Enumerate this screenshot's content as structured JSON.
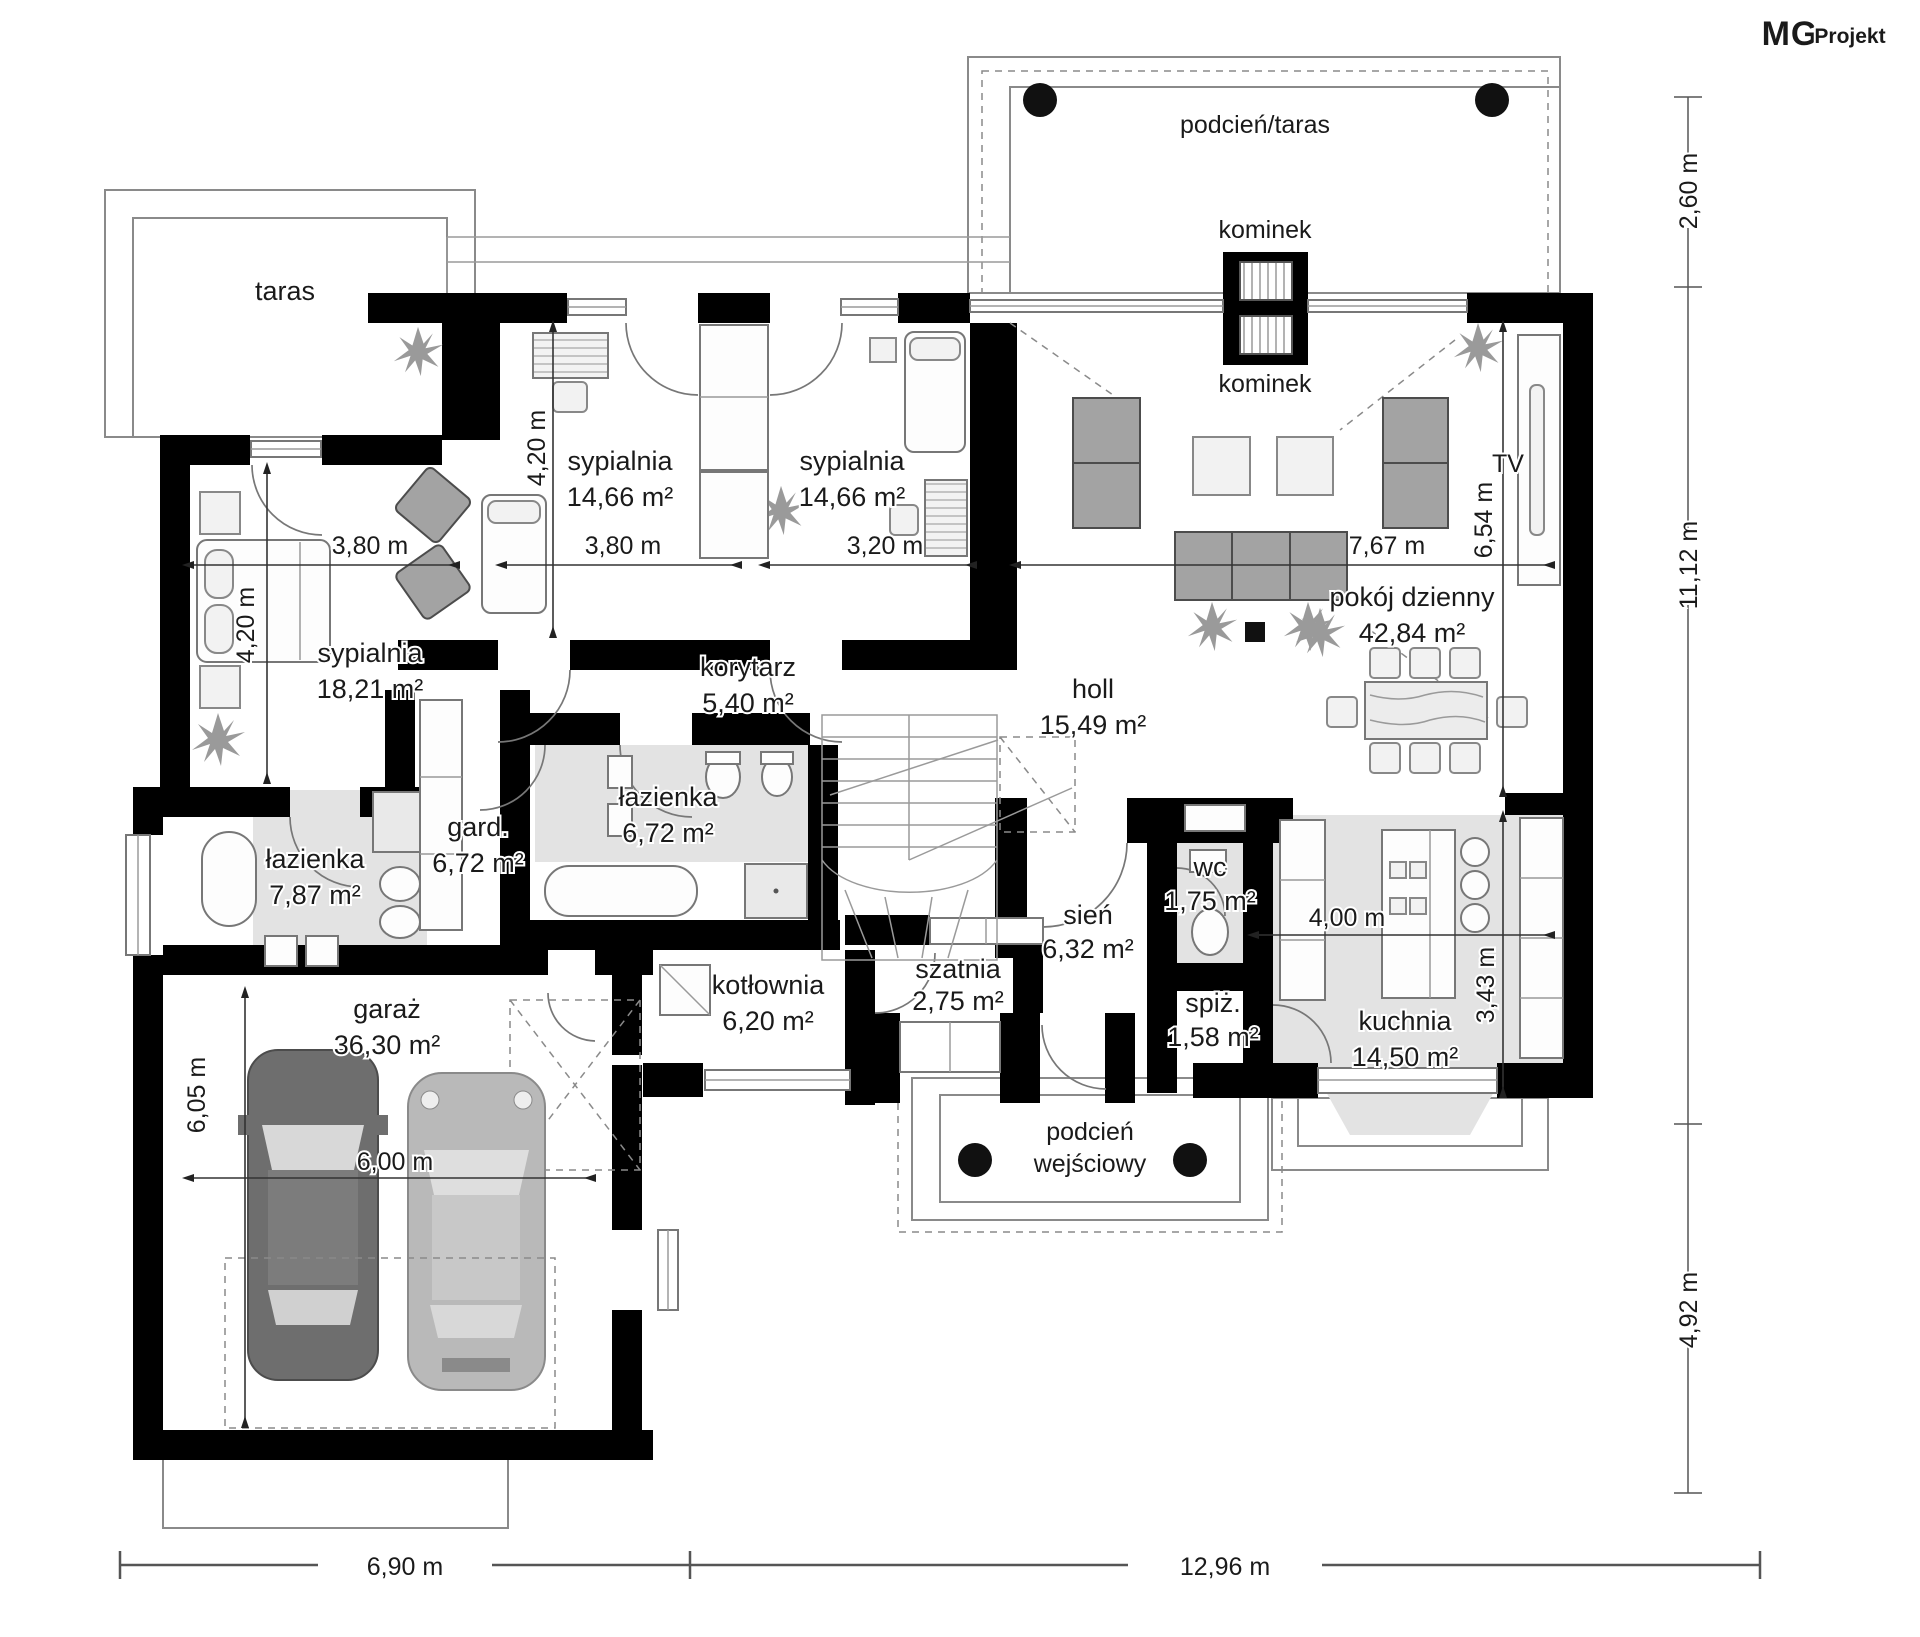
{
  "logo": {
    "mg": "MG",
    "projekt": "Projekt"
  },
  "outdoor": {
    "taras": "taras",
    "podcien_taras": "podcień/taras",
    "kominek_top": "kominek",
    "kominek_bottom": "kominek",
    "tv": "TV",
    "podcien_wejsciowy_1": "podcień",
    "podcien_wejsciowy_2": "wejściowy"
  },
  "rooms": {
    "sypialnia_18": {
      "name": "sypialnia",
      "area": "18,21 m²"
    },
    "sypialnia_14a": {
      "name": "sypialnia",
      "area": "14,66 m²"
    },
    "sypialnia_14b": {
      "name": "sypialnia",
      "area": "14,66 m²"
    },
    "pokoj_dzienny": {
      "name": "pokój dzienny",
      "area": "42,84 m²"
    },
    "korytarz": {
      "name": "korytarz",
      "area": "5,40 m²"
    },
    "holl": {
      "name": "holl",
      "area": "15,49 m²"
    },
    "lazienka_672": {
      "name": "łazienka",
      "area": "6,72 m²"
    },
    "gard": {
      "name": "gard.",
      "area": "6,72 m²"
    },
    "lazienka_787": {
      "name": "łazienka",
      "area": "7,87 m²"
    },
    "kotlownia": {
      "name": "kotłownia",
      "area": "6,20 m²"
    },
    "szatnia": {
      "name": "szatnia",
      "area": "2,75 m²"
    },
    "sien": {
      "name": "sień",
      "area": "6,32 m²"
    },
    "wc": {
      "name": "wc",
      "area": "1,75 m²"
    },
    "spiz": {
      "name": "spiż.",
      "area": "1,58 m²"
    },
    "kuchnia": {
      "name": "kuchnia",
      "area": "14,50 m²"
    },
    "garaz": {
      "name": "garaż",
      "area": "36,30 m²"
    }
  },
  "dimensions": {
    "right_top": "2,60 m",
    "right_mid": "11,12 m",
    "right_bottom": "4,92 m",
    "bottom_left": "6,90 m",
    "bottom_right": "12,96 m",
    "w_sypialnia18": "3,80 m",
    "w_sypialnia14a": "3,80 m",
    "w_sypialnia14b": "3,20 m",
    "w_pokoj": "7,67 m",
    "h_sypialnia18": "4,20 m",
    "h_sypialnia14a": "4,20 m",
    "h_pokoj": "6,54 m",
    "h_garaz": "6,05 m",
    "w_garaz": "6,00 m",
    "w_kuchnia": "4,00 m",
    "h_kuchnia": "3,43 m"
  },
  "colors": {
    "wall": "#000000",
    "wet_room_floor": "#e3e3e3",
    "furniture_gray": "#a3a3a3",
    "line_gray": "#8a8a8a"
  }
}
